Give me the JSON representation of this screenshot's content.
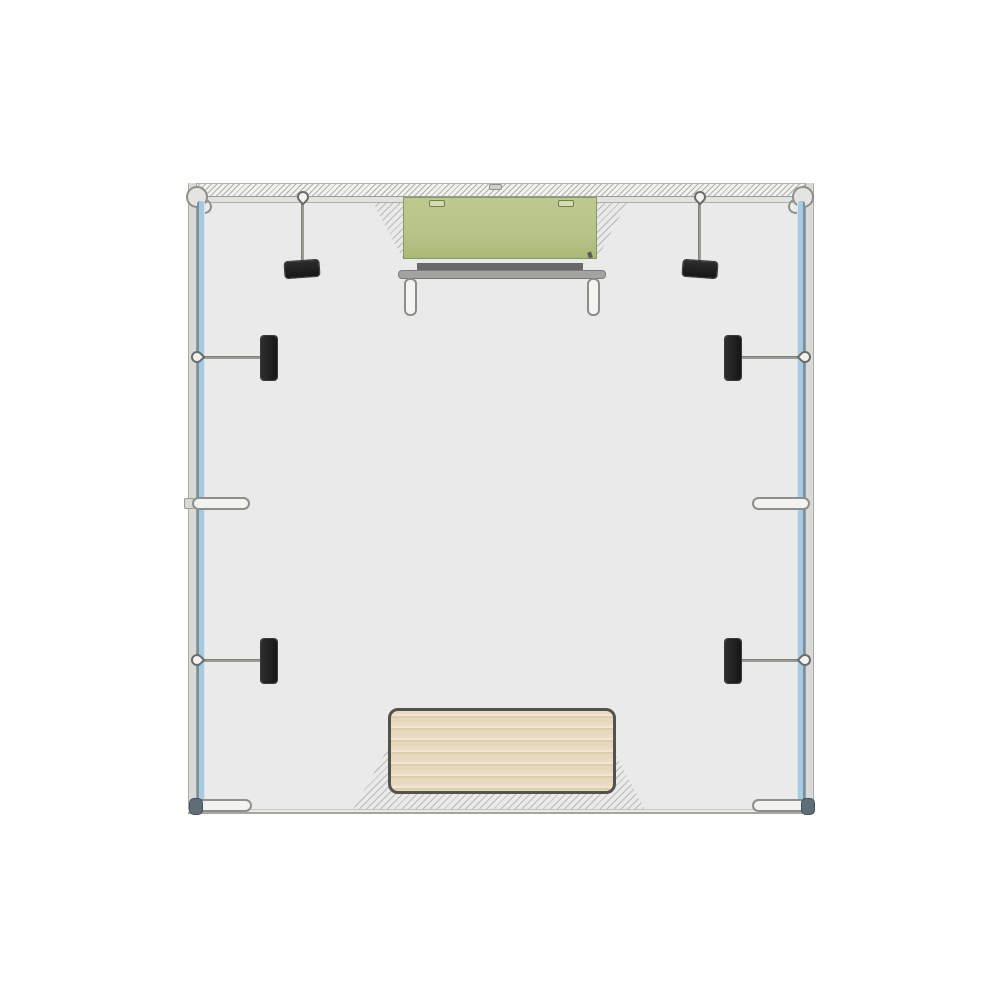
{
  "document": {
    "title": "Exhibition booth frame — top view plan drawing"
  },
  "diagram": {
    "type": "floor-plan",
    "view": "top-down",
    "components": {
      "booth": "Square exhibition booth frame, top view",
      "back_wall": "Back wall extrusion with hatched section",
      "side_wall": "Side wall extrusion",
      "left_panel": "Left side fabric panel (blue)",
      "right_panel": "Right side fabric panel (blue)",
      "corner_connector": "Corner connector (round joint)",
      "corner_hook": "Corner tension hook",
      "top_notch": "Center connector notch",
      "monitor": "Wall-mounted monitor / header (green), plan projection",
      "monitor_notch": "Monitor mounting clip",
      "shelf_bar": "Monitor mount crossbar",
      "support_bar": "Mount support rail",
      "leg": "Mount leg with rounded cap",
      "anchor_pin": "Frame anchor pin (teardrop)",
      "strut_rod": "Support strut rod",
      "clamp": "Clamp fixture (black)",
      "baseplate": "Base plate foot",
      "end_cap": "Panel end cap",
      "counter": "Wood counter top, plan view",
      "floor_shadow": "Hatched floor shading"
    }
  },
  "colors": {
    "page_bg": "#ffffff",
    "interior": "#eaeaea",
    "wall_band": "#d9d9d5",
    "wall_line": "#9c9c98",
    "panel_blue": "#a7cade",
    "panel_blue_edge": "#7590a0",
    "monitor_green": "#b7c489",
    "monitor_green_edge": "#8a9a5e",
    "shelf_dark": "#696969",
    "shelf_light": "#a3a39f",
    "clamp_black": "#161616",
    "rod_gray": "#9a9a96",
    "leg_edge": "#8c8c88",
    "wood_base": "#e9dcc2",
    "wood_grain": "#dccdae",
    "wood_edge": "#55514b",
    "cap_dark": "#5f6d77"
  }
}
